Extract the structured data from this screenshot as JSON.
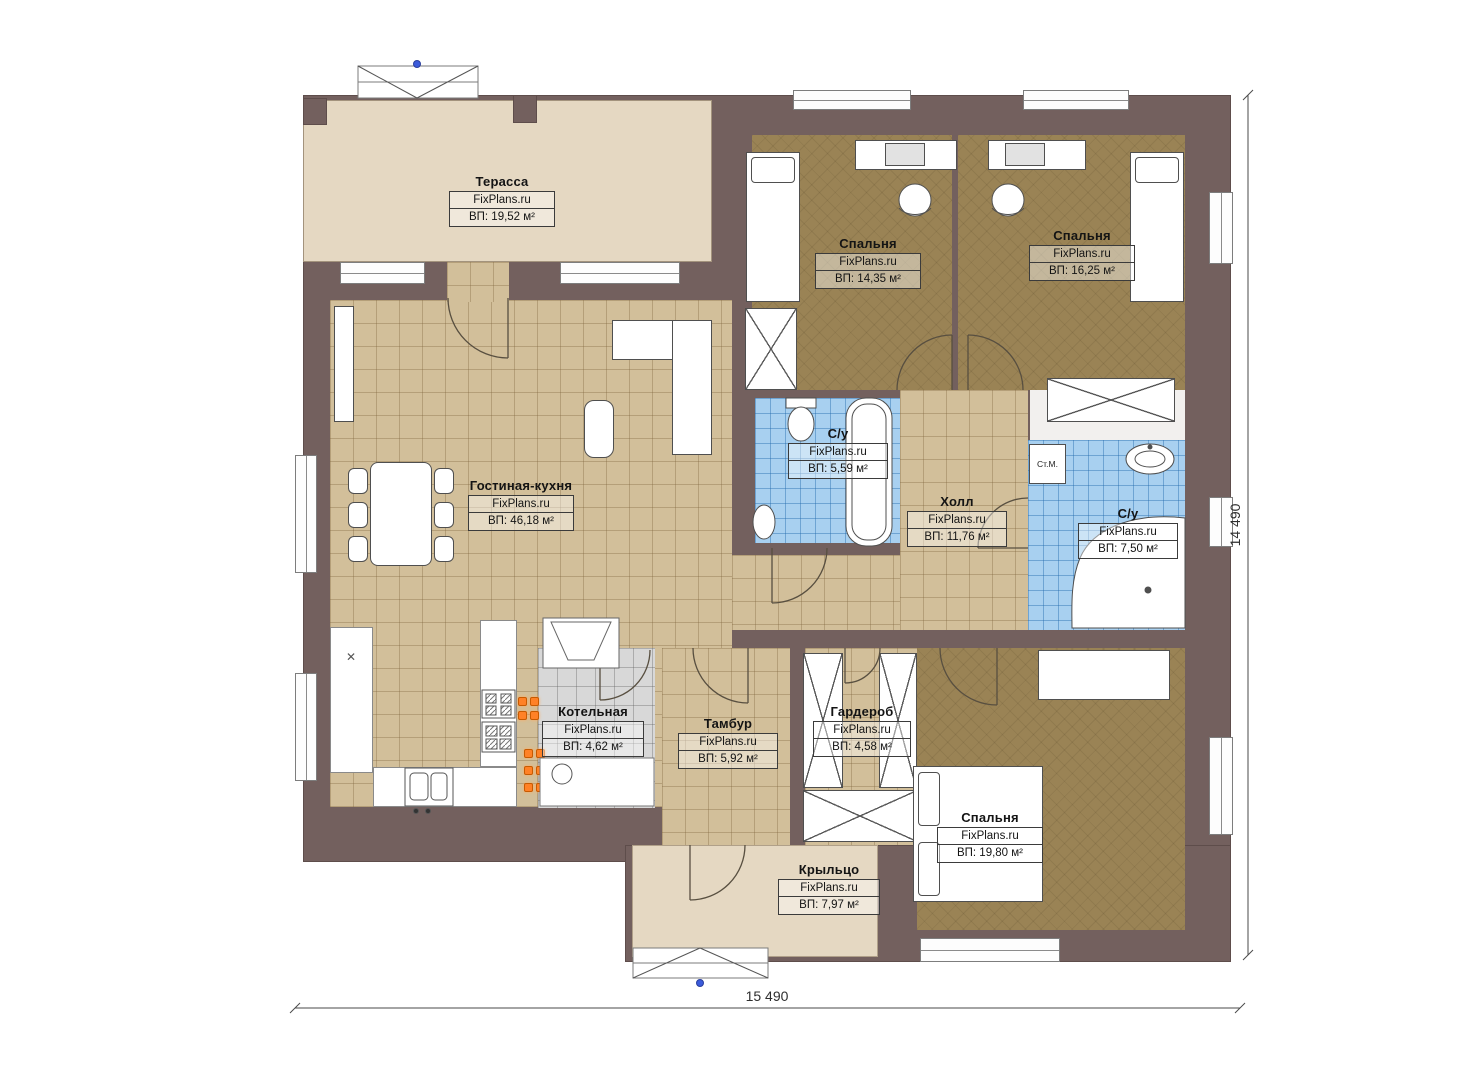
{
  "site_brand": "FixPlans.ru",
  "rooms": [
    {
      "id": "terrace",
      "name": "Терасса",
      "brand": "FixPlans.ru",
      "area": "ВП: 19,52 м²"
    },
    {
      "id": "bedroom-top-left",
      "name": "Спальня",
      "brand": "FixPlans.ru",
      "area": "ВП: 14,35 м²"
    },
    {
      "id": "bedroom-top-right",
      "name": "Спальня",
      "brand": "FixPlans.ru",
      "area": "ВП: 16,25 м²"
    },
    {
      "id": "bathroom-small",
      "name": "С/у",
      "brand": "FixPlans.ru",
      "area": "ВП: 5,59 м²"
    },
    {
      "id": "hall",
      "name": "Холл",
      "brand": "FixPlans.ru",
      "area": "ВП: 11,76 м²"
    },
    {
      "id": "bathroom-large",
      "name": "С/у",
      "brand": "FixPlans.ru",
      "area": "ВП: 7,50 м²"
    },
    {
      "id": "living-kitchen",
      "name": "Гостиная-кухня",
      "brand": "FixPlans.ru",
      "area": "ВП: 46,18 м²"
    },
    {
      "id": "boiler-room",
      "name": "Котельная",
      "brand": "FixPlans.ru",
      "area": "ВП: 4,62 м²"
    },
    {
      "id": "vestibule",
      "name": "Тамбур",
      "brand": "FixPlans.ru",
      "area": "ВП: 5,92 м²"
    },
    {
      "id": "wardrobe",
      "name": "Гардероб",
      "brand": "FixPlans.ru",
      "area": "ВП: 4,58 м²"
    },
    {
      "id": "bedroom-bottom",
      "name": "Спальня",
      "brand": "FixPlans.ru",
      "area": "ВП: 19,80 м²"
    },
    {
      "id": "porch",
      "name": "Крыльцо",
      "brand": "FixPlans.ru",
      "area": "ВП: 7,97 м²"
    }
  ],
  "annotations": {
    "washing_machine": "Ст.М."
  },
  "dimensions": {
    "width": "15 490",
    "height": "14 490"
  },
  "colors": {
    "wall": "#73605e",
    "floor_tile_tan": "#d2bf9a",
    "floor_bedroom": "#9a8355",
    "floor_wet_blue": "#a8d0f0",
    "floor_boiler_gray": "#d8d8d8",
    "floor_terrace_beige": "#e5d8c2",
    "radiator_orange": "#ff8126"
  }
}
